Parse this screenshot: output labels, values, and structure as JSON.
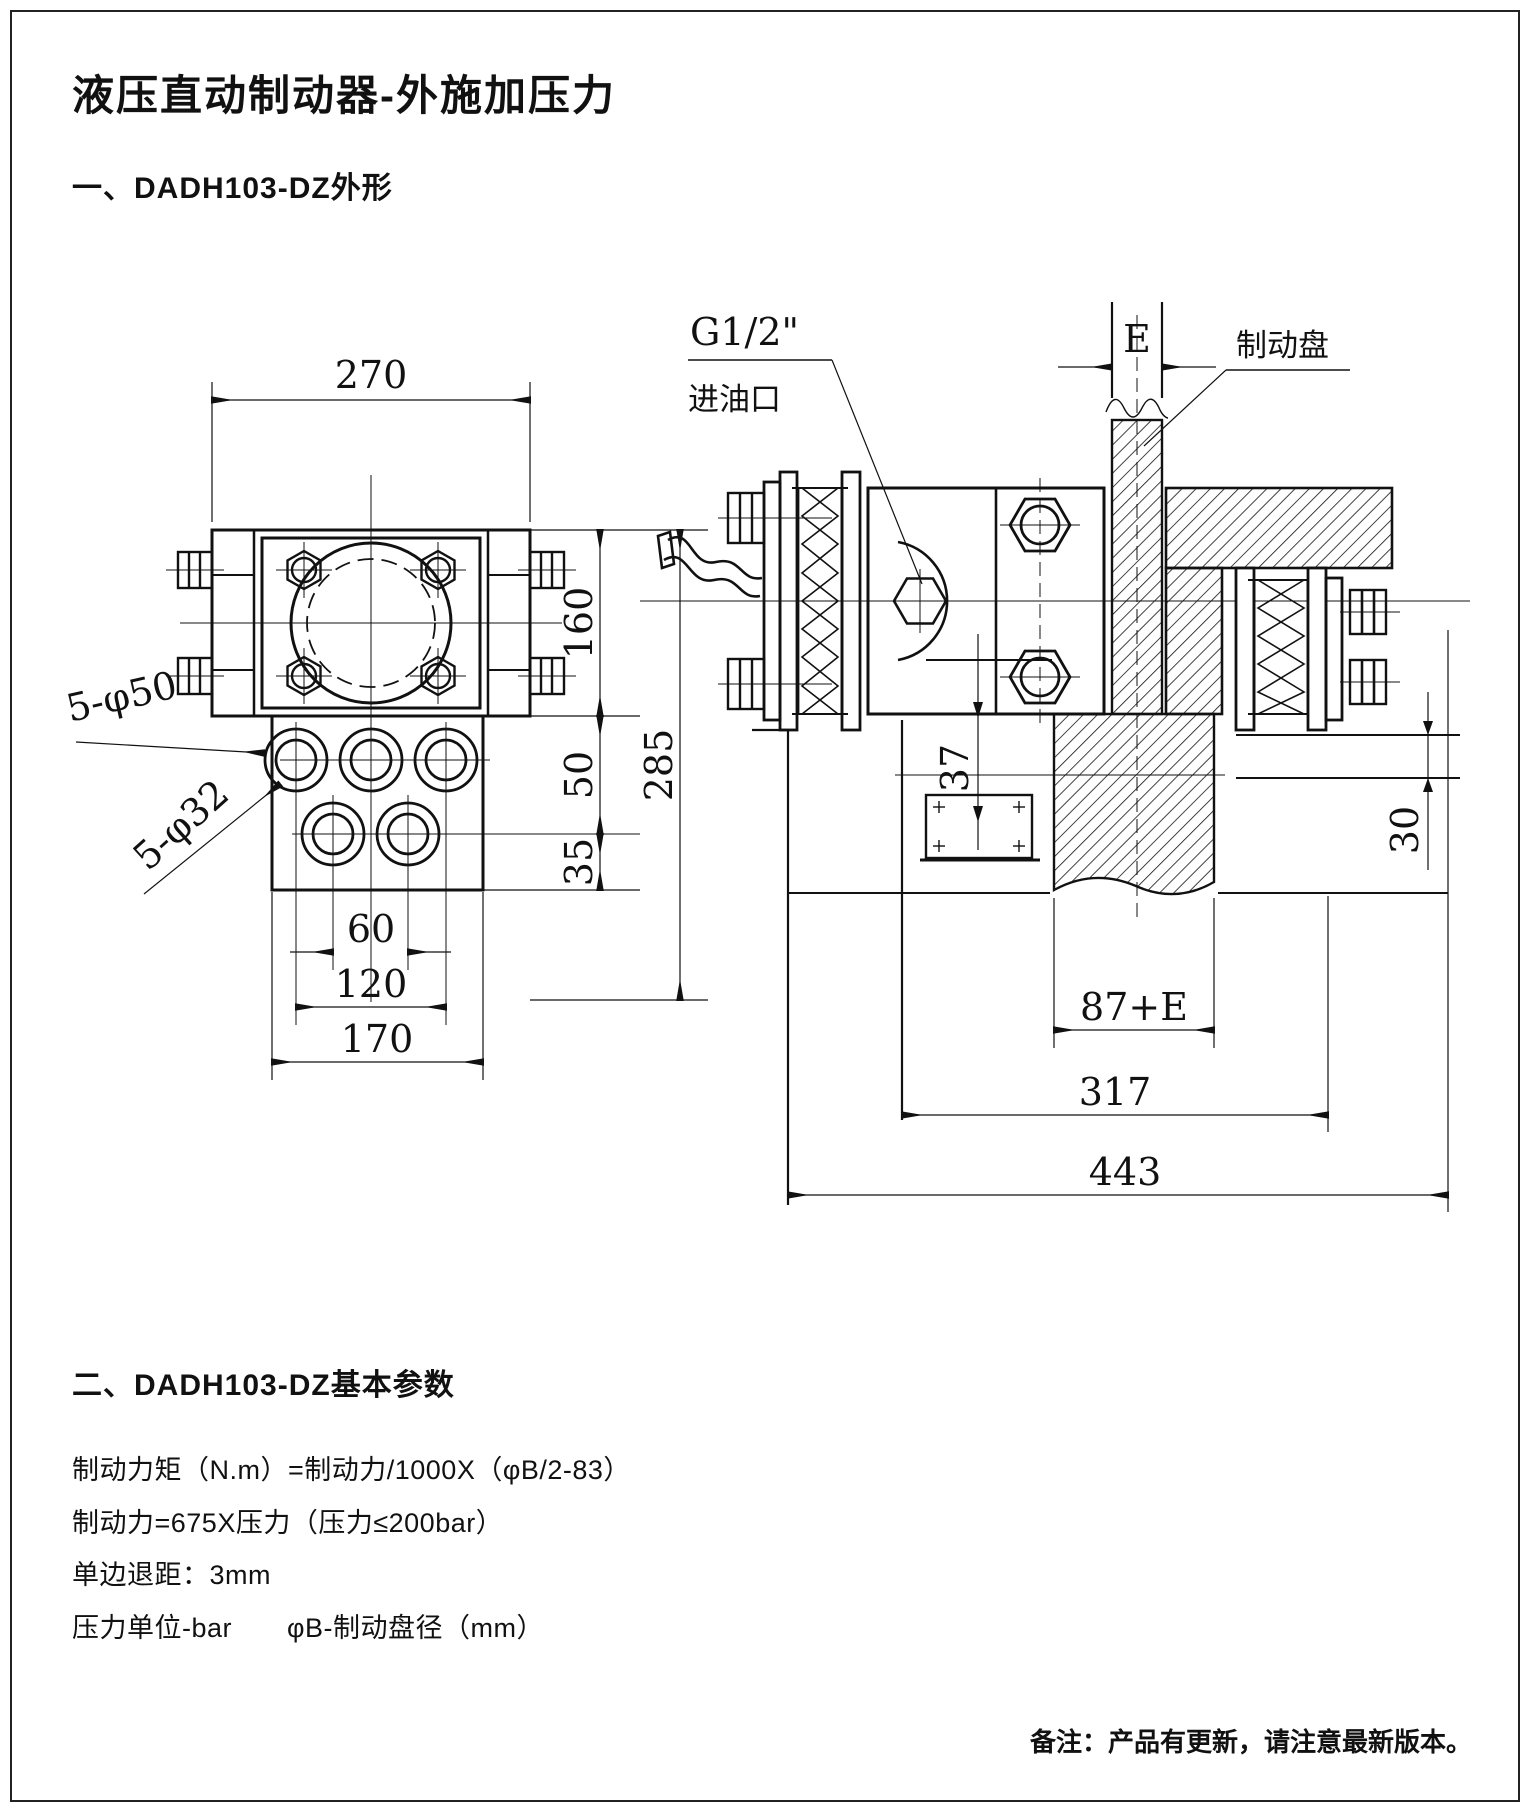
{
  "page": {
    "title": "液压直动制动器-外施加压力",
    "section1": "一、DADH103-DZ外形",
    "section2": "二、DADH103-DZ基本参数",
    "params": [
      "制动力矩（N.m）=制动力/1000X（φB/2-83）",
      "制动力=675X压力（压力≤200bar）",
      "单边退距：3mm",
      "压力单位-bar　　φB-制动盘径（mm）"
    ],
    "footer": "备注：产品有更新，请注意最新版本。"
  },
  "front_view": {
    "dims": {
      "width": "270",
      "height_upper": "160",
      "height_total": "285",
      "hole_offset": "50",
      "hole_row_gap": "35",
      "bottom_hole_spacing": "60",
      "top_hole_spacing": "120",
      "manifold_width": "170"
    },
    "labels": {
      "holes_large": "5-φ50",
      "holes_small": "5-φ32"
    }
  },
  "side_view": {
    "labels": {
      "port_thread": "G1/2\"",
      "port_name": "进油口",
      "disc_gap": "E",
      "disc_name": "制动盘"
    },
    "dims": {
      "pad_travel": "37",
      "flange_offset": "30",
      "hub_width": "87+E",
      "mount_width": "317",
      "total_width": "443"
    }
  }
}
